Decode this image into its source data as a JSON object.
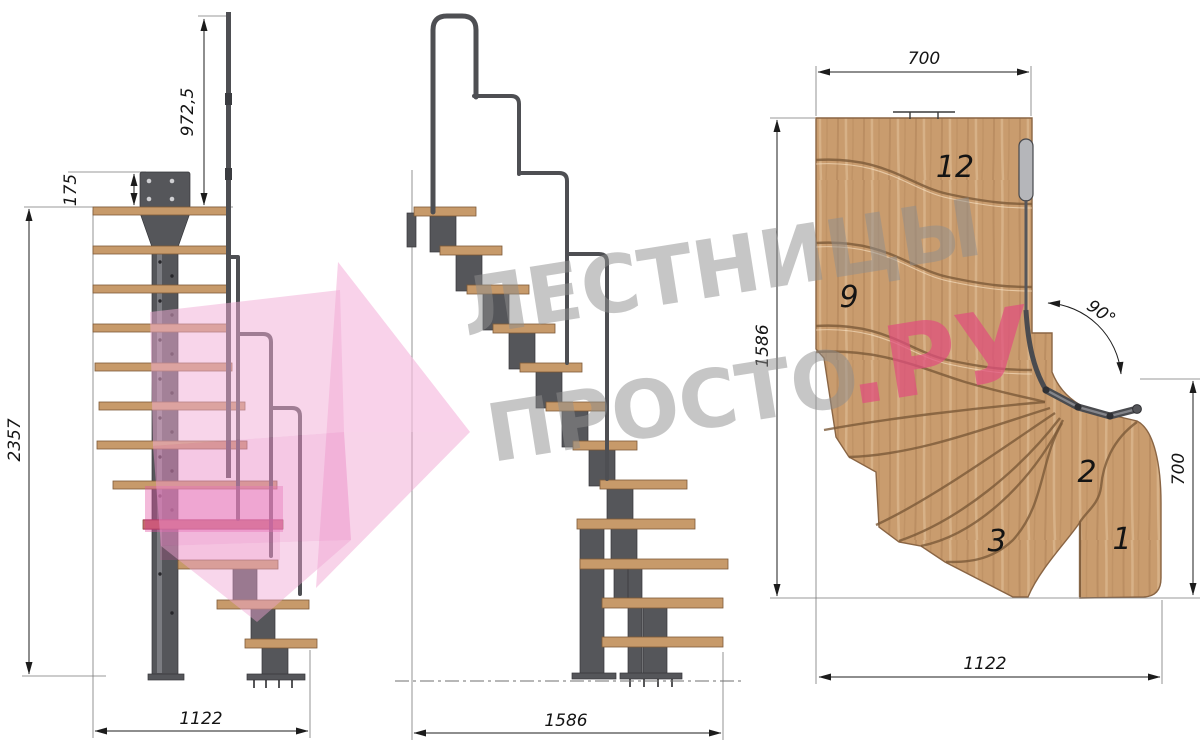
{
  "front_view": {
    "dim_plate_offset": "175",
    "dim_handrail_height": "972,5",
    "dim_total_height": "2357",
    "dim_base_width": "1122"
  },
  "side_view": {
    "dim_base_length": "1586"
  },
  "plan_view": {
    "dim_top_width": "700",
    "dim_side_length": "1586",
    "dim_turn_angle": "90°",
    "dim_right_width": "700",
    "dim_bottom_width": "1122",
    "step_labels": {
      "top": "12",
      "mid": "9",
      "s2": "2",
      "s3": "3",
      "s1": "1"
    }
  },
  "watermark": {
    "brand_line1": "ЛЕСТНИЦЫ",
    "brand_line2": "ПРОСТО",
    "brand_suffix": ".РУ"
  },
  "colors": {
    "wood": "#c99c6e",
    "steel": "#55565a",
    "dimension": "#1c1c1c",
    "watermark_gray": "#8f8f8f",
    "watermark_pink": "#e14f7e",
    "arrow_pink": "#f2a8d4",
    "highlight_pink": "#e052a2"
  }
}
